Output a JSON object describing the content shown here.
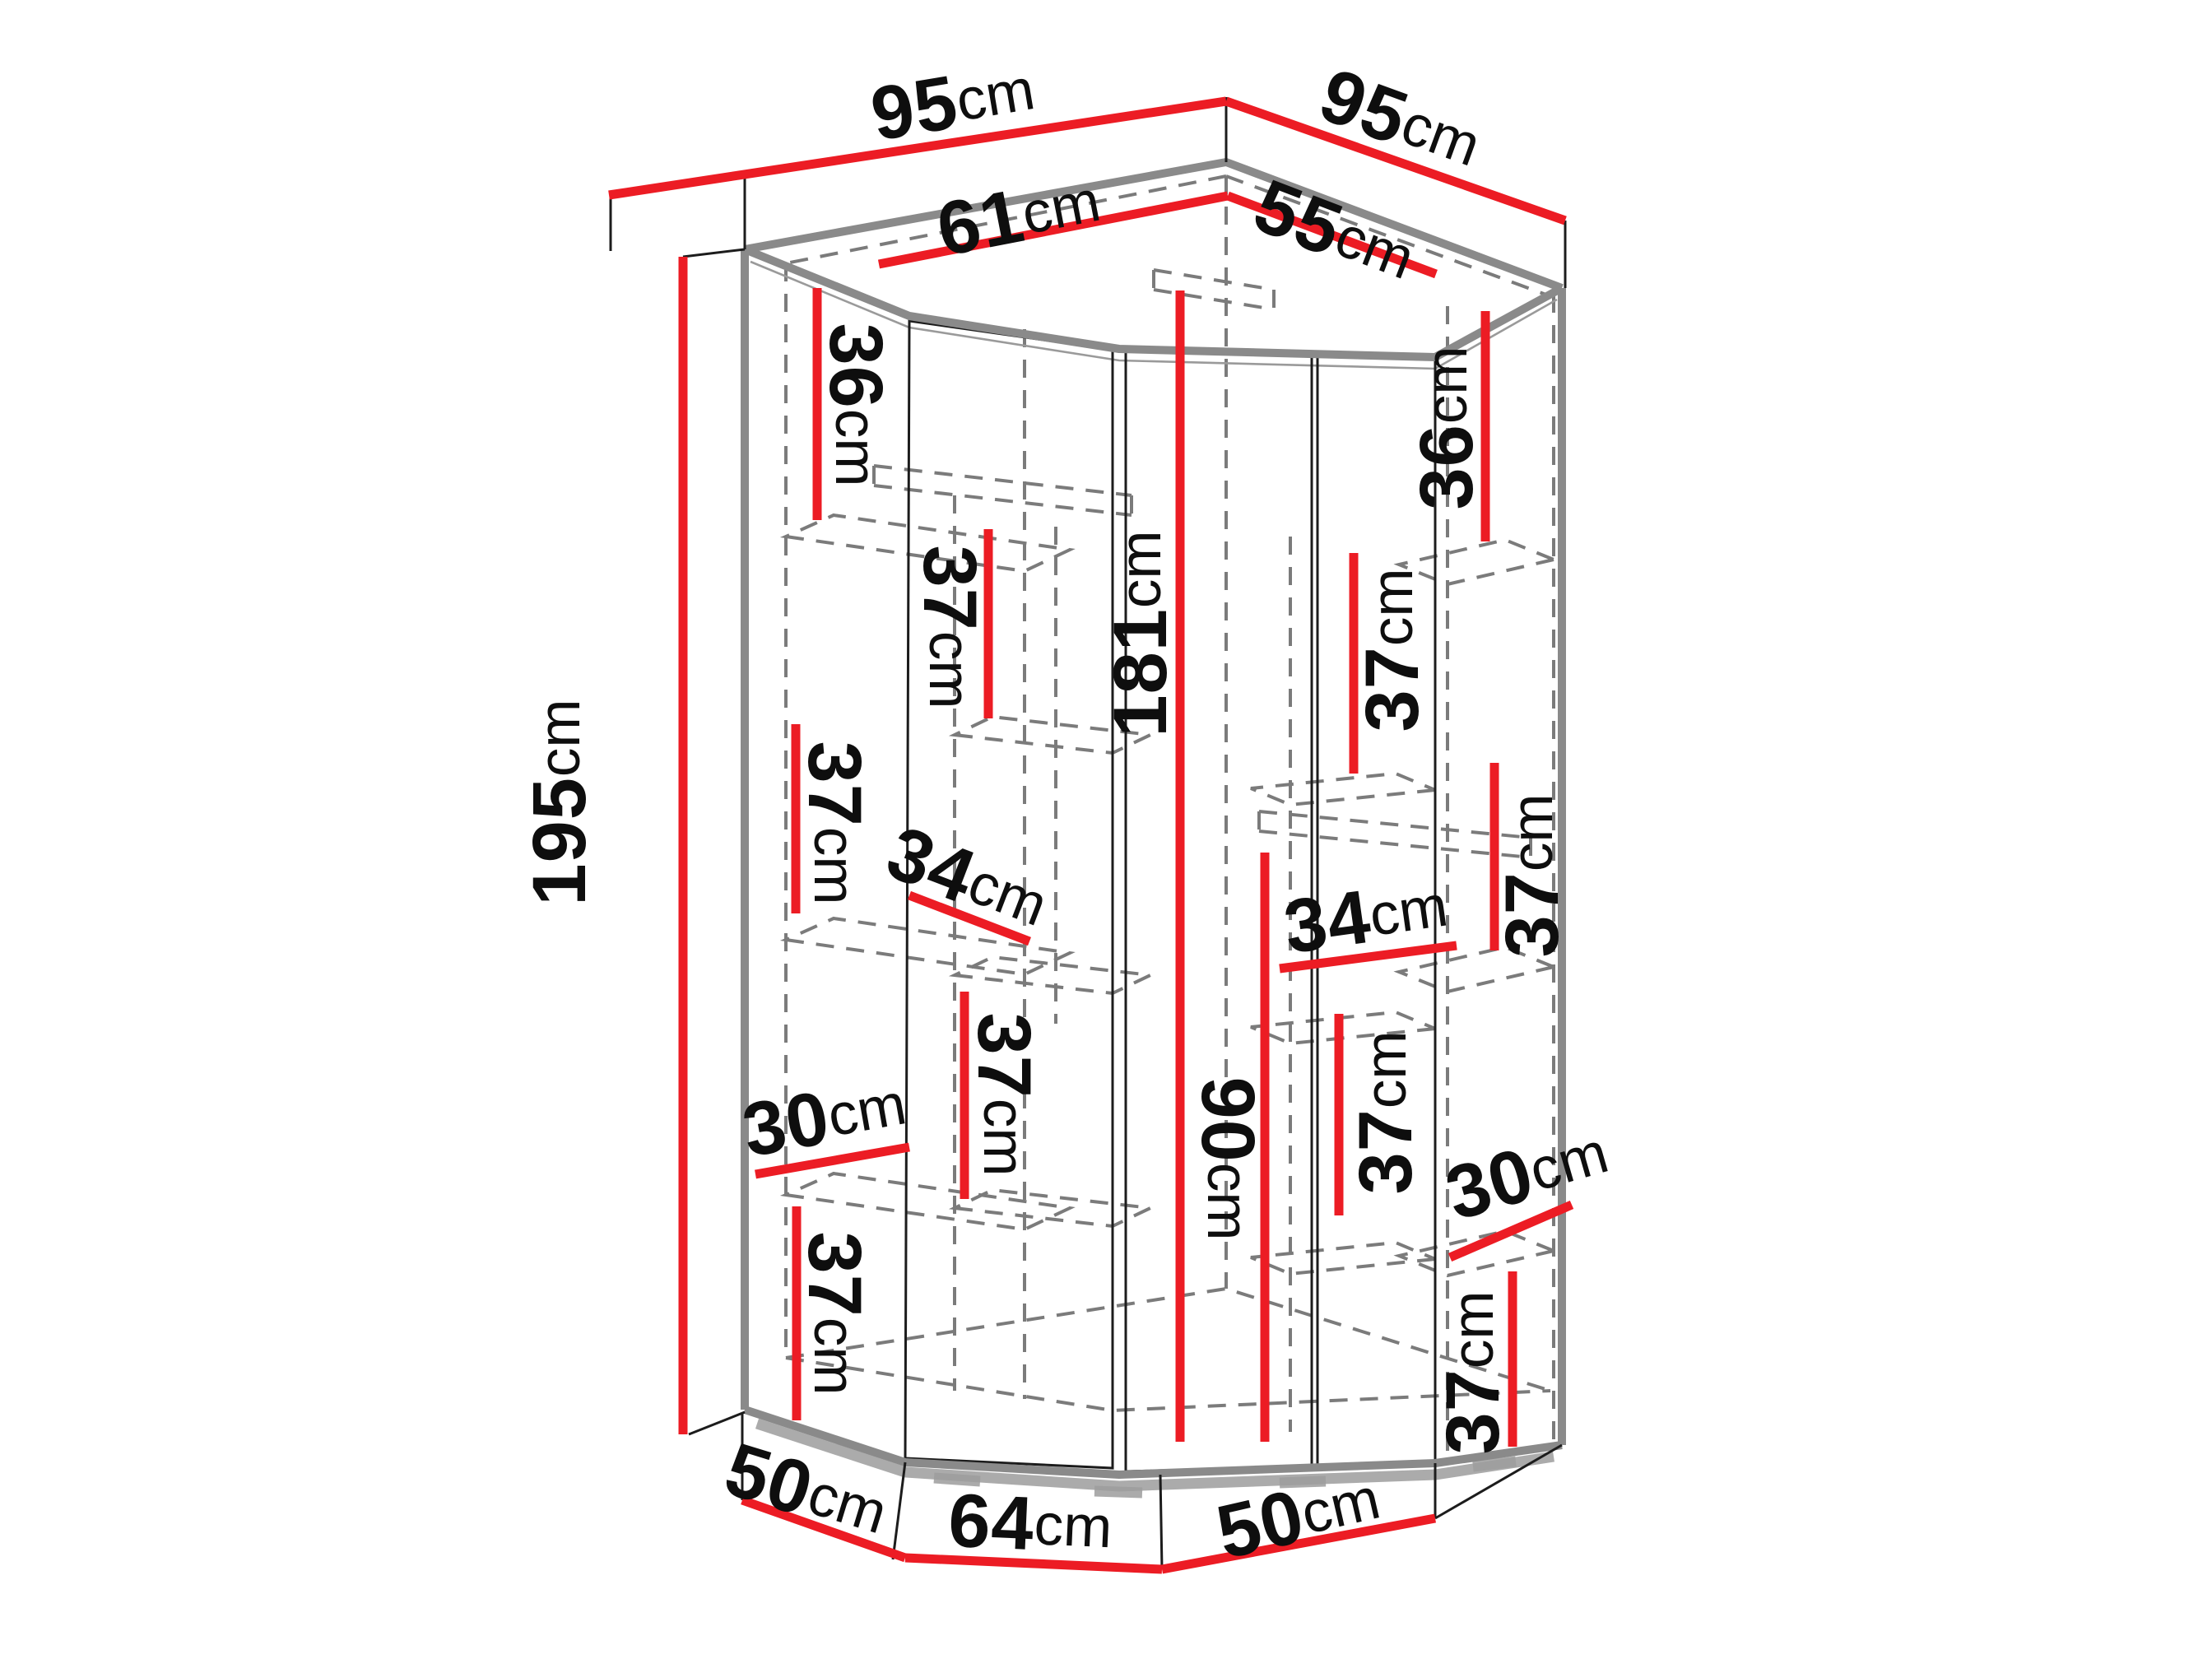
{
  "diagram": {
    "type": "furniture dimension drawing",
    "subject": "corner wardrobe with shelves, isometric view",
    "unit": "cm",
    "colors": {
      "dimension_line": "#ec1c24",
      "edge_gray": "#8a8a8a",
      "dashed_gray": "#7b7b7b",
      "outline_black": "#1c1c1c",
      "text": "#0e0e0e",
      "background": "#ffffff"
    },
    "dims": {
      "top_left_width": {
        "value": "95",
        "unit": "cm"
      },
      "top_right_width": {
        "value": "95",
        "unit": "cm"
      },
      "inner_left_top": {
        "value": "61",
        "unit": "cm"
      },
      "inner_right_top": {
        "value": "55",
        "unit": "cm"
      },
      "total_height": {
        "value": "195",
        "unit": "cm"
      },
      "interior_height": {
        "value": "181",
        "unit": "cm"
      },
      "hanging_height": {
        "value": "90",
        "unit": "cm"
      },
      "left_shelf_1": {
        "value": "36",
        "unit": "cm"
      },
      "left_shelf_2": {
        "value": "37",
        "unit": "cm"
      },
      "left_shelf_3": {
        "value": "37",
        "unit": "cm"
      },
      "left_depth_mid": {
        "value": "34",
        "unit": "cm"
      },
      "left_shelf_4": {
        "value": "37",
        "unit": "cm"
      },
      "left_depth_low": {
        "value": "30",
        "unit": "cm"
      },
      "left_shelf_5": {
        "value": "37",
        "unit": "cm"
      },
      "right_shelf_1": {
        "value": "36",
        "unit": "cm"
      },
      "right_shelf_2": {
        "value": "37",
        "unit": "cm"
      },
      "right_shelf_3": {
        "value": "37",
        "unit": "cm"
      },
      "right_depth_mid": {
        "value": "34",
        "unit": "cm"
      },
      "right_shelf_4": {
        "value": "37",
        "unit": "cm"
      },
      "right_depth_low": {
        "value": "30",
        "unit": "cm"
      },
      "right_shelf_5": {
        "value": "37",
        "unit": "cm"
      },
      "base_left": {
        "value": "50",
        "unit": "cm"
      },
      "base_front": {
        "value": "64",
        "unit": "cm"
      },
      "base_right": {
        "value": "50",
        "unit": "cm"
      }
    }
  }
}
